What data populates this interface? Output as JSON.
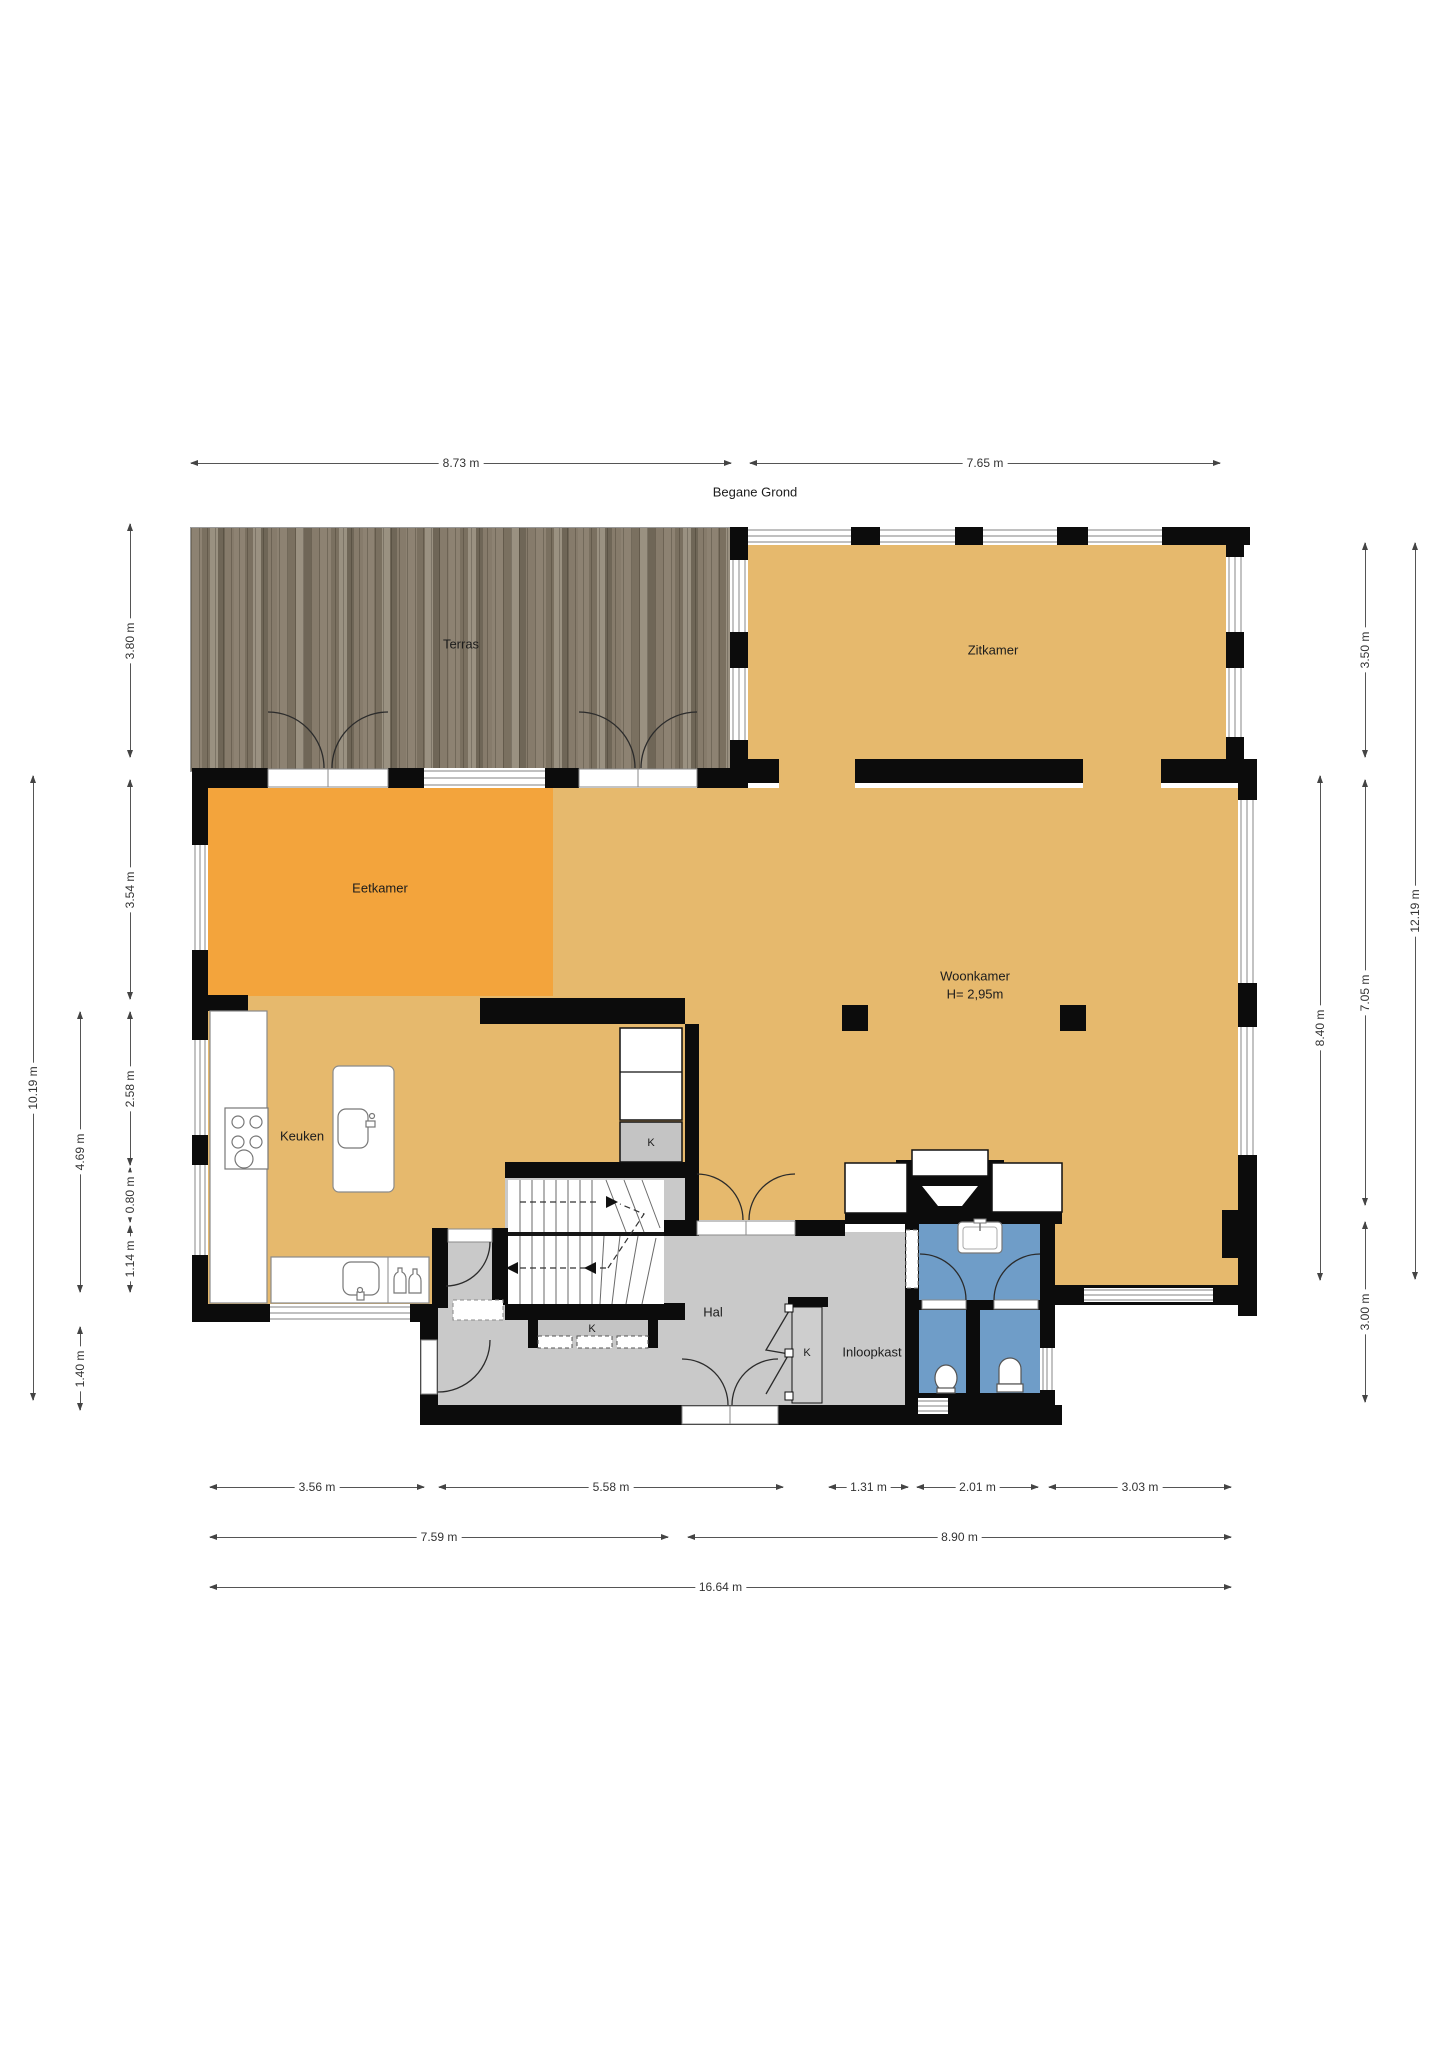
{
  "title": "Begane Grond",
  "rooms": {
    "terras": "Terras",
    "zitkamer": "Zitkamer",
    "eetkamer": "Eetkamer",
    "woonkamer": {
      "name": "Woonkamer",
      "height": "H= 2,95m"
    },
    "keuken": "Keuken",
    "hal": "Hal",
    "inloopkast": "Inloopkast",
    "k": "K"
  },
  "dims": {
    "top": [
      "8.73 m",
      "7.65 m"
    ],
    "left": [
      "3.80 m",
      "3.54 m",
      "2.58 m",
      "0.80 m",
      "1.14 m",
      "4.69 m",
      "1.40 m",
      "10.19 m"
    ],
    "right": [
      "3.50 m",
      "7.05 m",
      "3.00 m",
      "8.40 m",
      "12.19 m"
    ],
    "bottom": [
      "3.56 m",
      "5.58 m",
      "1.31 m",
      "2.01 m",
      "3.03 m",
      "7.59 m",
      "8.90 m",
      "16.64 m"
    ]
  },
  "colors": {
    "floor_tan": "#e6b96d",
    "dining_orange": "#f3a43c",
    "hall_gray": "#c9c9c9",
    "bath_blue": "#6f9dc8",
    "wall_black": "#0c0c0c",
    "deck_wood": "#85796a"
  }
}
